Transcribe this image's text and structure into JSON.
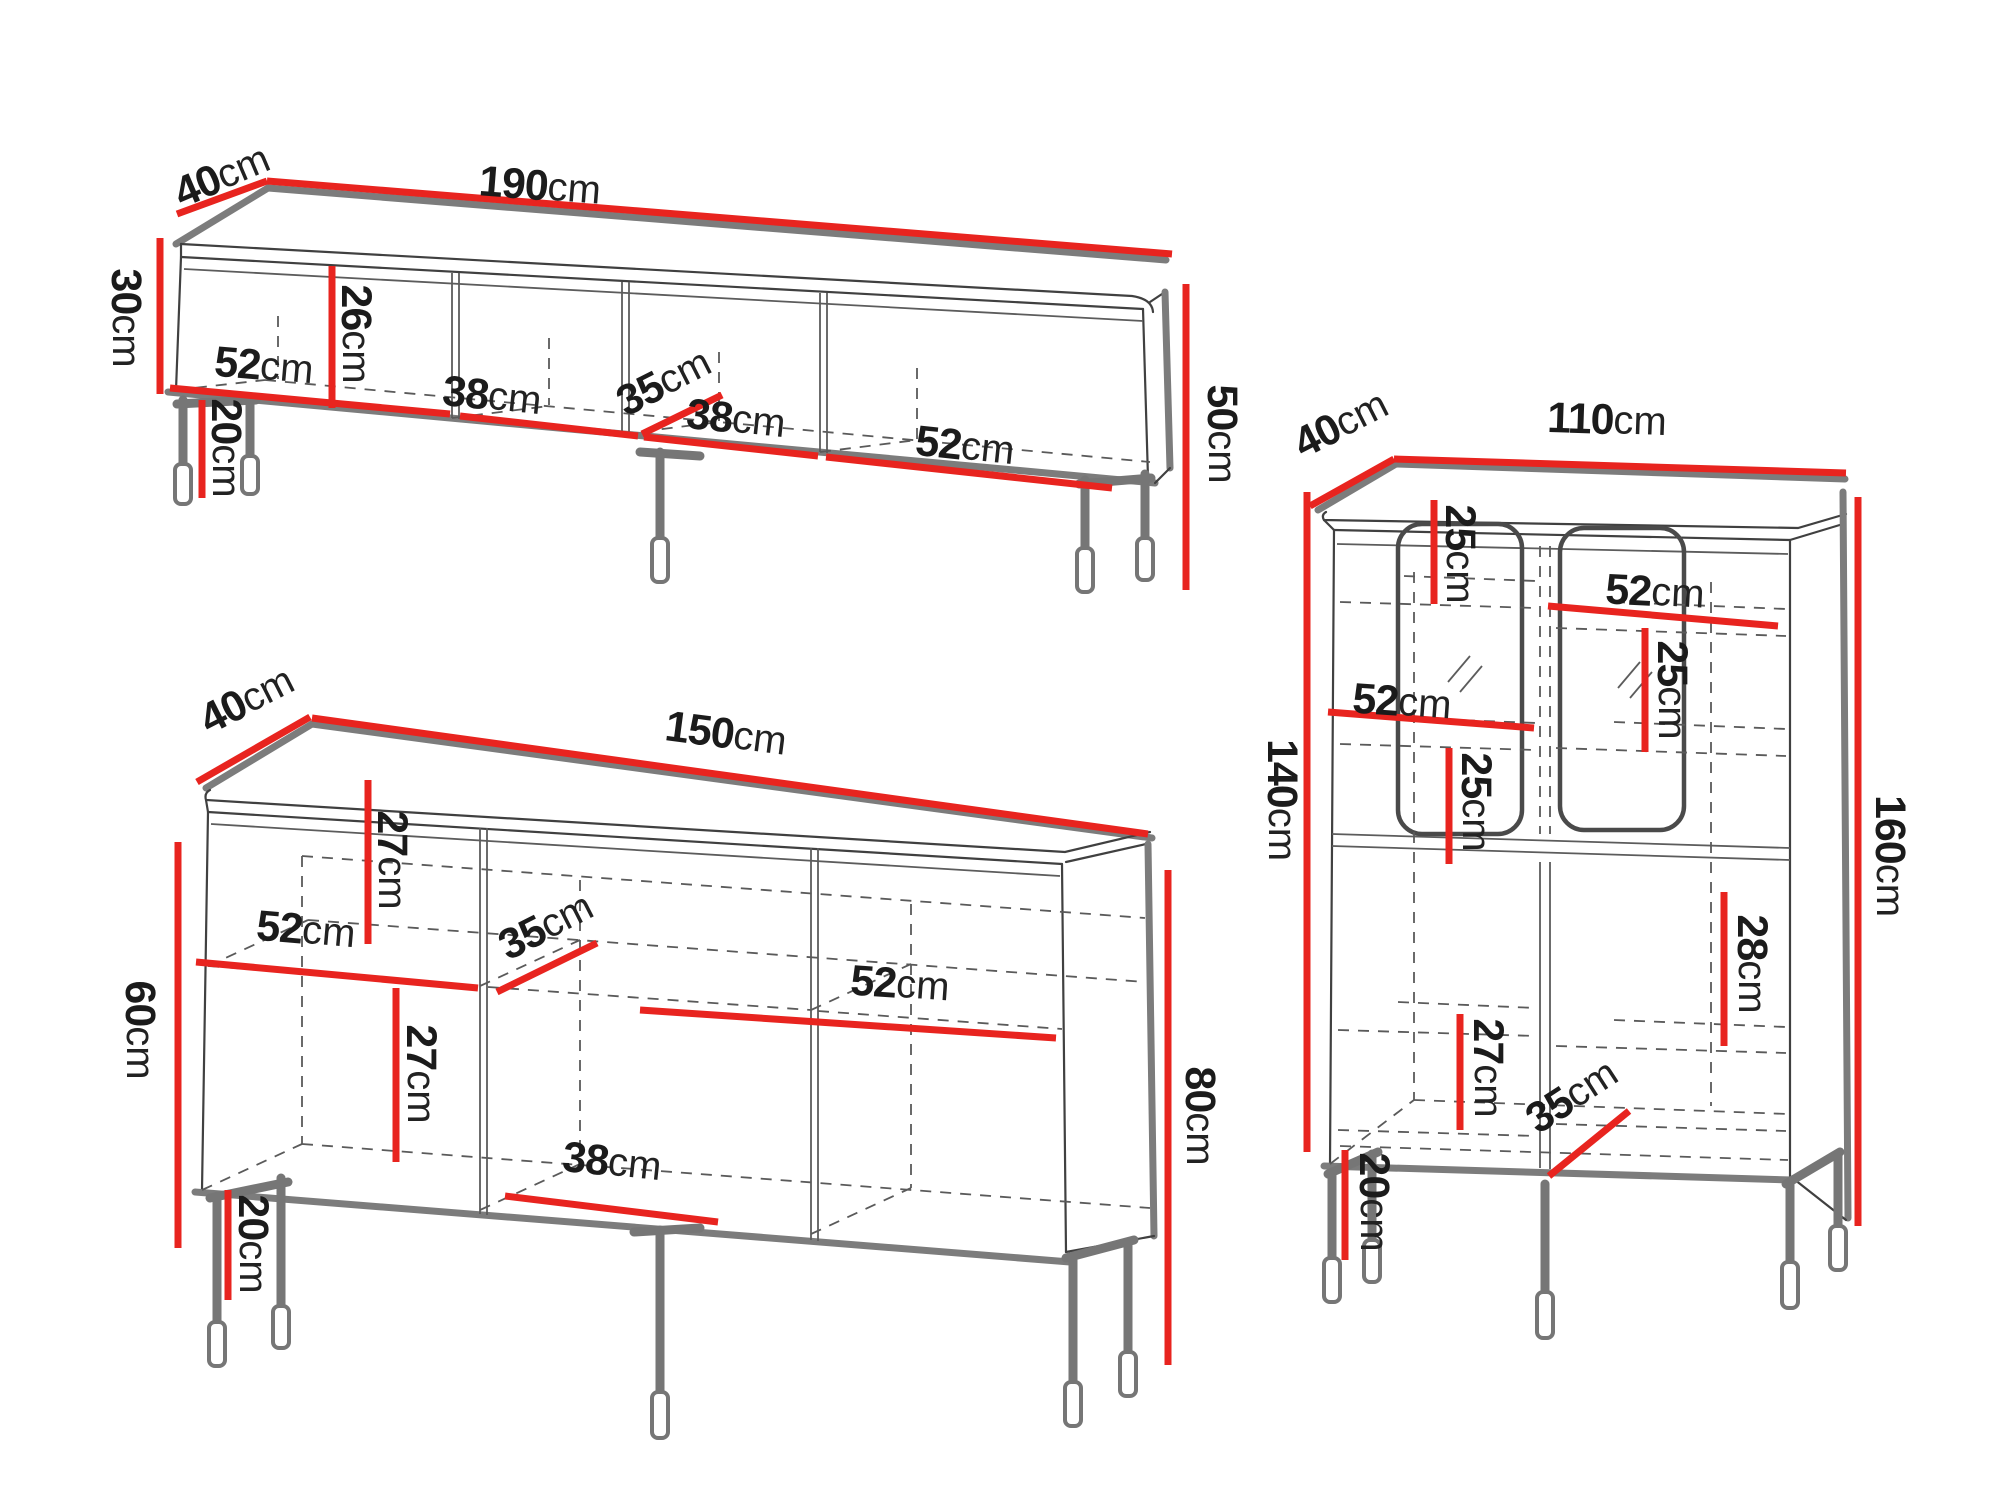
{
  "diagram": {
    "kind": "furniture-dimension-drawing",
    "units_count": 3,
    "measure_unit": "cm"
  },
  "colors": {
    "dimension_red": "#e8241f",
    "outline_gray": "#7c7c7c",
    "line_dark": "#404040",
    "text": "#1b1b1b",
    "background": "#ffffff"
  },
  "units": {
    "tv_stand": {
      "labels": {
        "depth": {
          "v": "40",
          "u": "cm"
        },
        "width": {
          "v": "190",
          "u": "cm"
        },
        "body_height": {
          "v": "30",
          "u": "cm"
        },
        "total_height": {
          "v": "50",
          "u": "cm"
        },
        "shelf_height": {
          "v": "26",
          "u": "cm"
        },
        "section_left_width": {
          "v": "52",
          "u": "cm"
        },
        "section_mid1_width": {
          "v": "38",
          "u": "cm"
        },
        "inner_depth": {
          "v": "35",
          "u": "cm"
        },
        "section_mid2_width": {
          "v": "38",
          "u": "cm"
        },
        "section_right_width": {
          "v": "52",
          "u": "cm"
        },
        "leg_height": {
          "v": "20",
          "u": "cm"
        }
      }
    },
    "sideboard": {
      "labels": {
        "depth": {
          "v": "40",
          "u": "cm"
        },
        "width": {
          "v": "150",
          "u": "cm"
        },
        "body_height": {
          "v": "60",
          "u": "cm"
        },
        "total_height": {
          "v": "80",
          "u": "cm"
        },
        "top_shelf_height": {
          "v": "27",
          "u": "cm"
        },
        "section_left_width": {
          "v": "52",
          "u": "cm"
        },
        "inner_depth": {
          "v": "35",
          "u": "cm"
        },
        "bottom_shelf_height": {
          "v": "27",
          "u": "cm"
        },
        "section_mid_width": {
          "v": "38",
          "u": "cm"
        },
        "section_right_width": {
          "v": "52",
          "u": "cm"
        },
        "leg_height": {
          "v": "20",
          "u": "cm"
        }
      }
    },
    "display_cabinet": {
      "labels": {
        "depth": {
          "v": "40",
          "u": "cm"
        },
        "width": {
          "v": "110",
          "u": "cm"
        },
        "body_height": {
          "v": "140",
          "u": "cm"
        },
        "total_height": {
          "v": "160",
          "u": "cm"
        },
        "top_shelf_height": {
          "v": "25",
          "u": "cm"
        },
        "right_top_width": {
          "v": "52",
          "u": "cm"
        },
        "right_shelf_height": {
          "v": "25",
          "u": "cm"
        },
        "left_mid_width": {
          "v": "52",
          "u": "cm"
        },
        "left_shelf_height": {
          "v": "25",
          "u": "cm"
        },
        "right_door_height": {
          "v": "28",
          "u": "cm"
        },
        "left_door_height": {
          "v": "27",
          "u": "cm"
        },
        "inner_depth": {
          "v": "35",
          "u": "cm"
        },
        "leg_height": {
          "v": "20",
          "u": "cm"
        }
      }
    }
  }
}
